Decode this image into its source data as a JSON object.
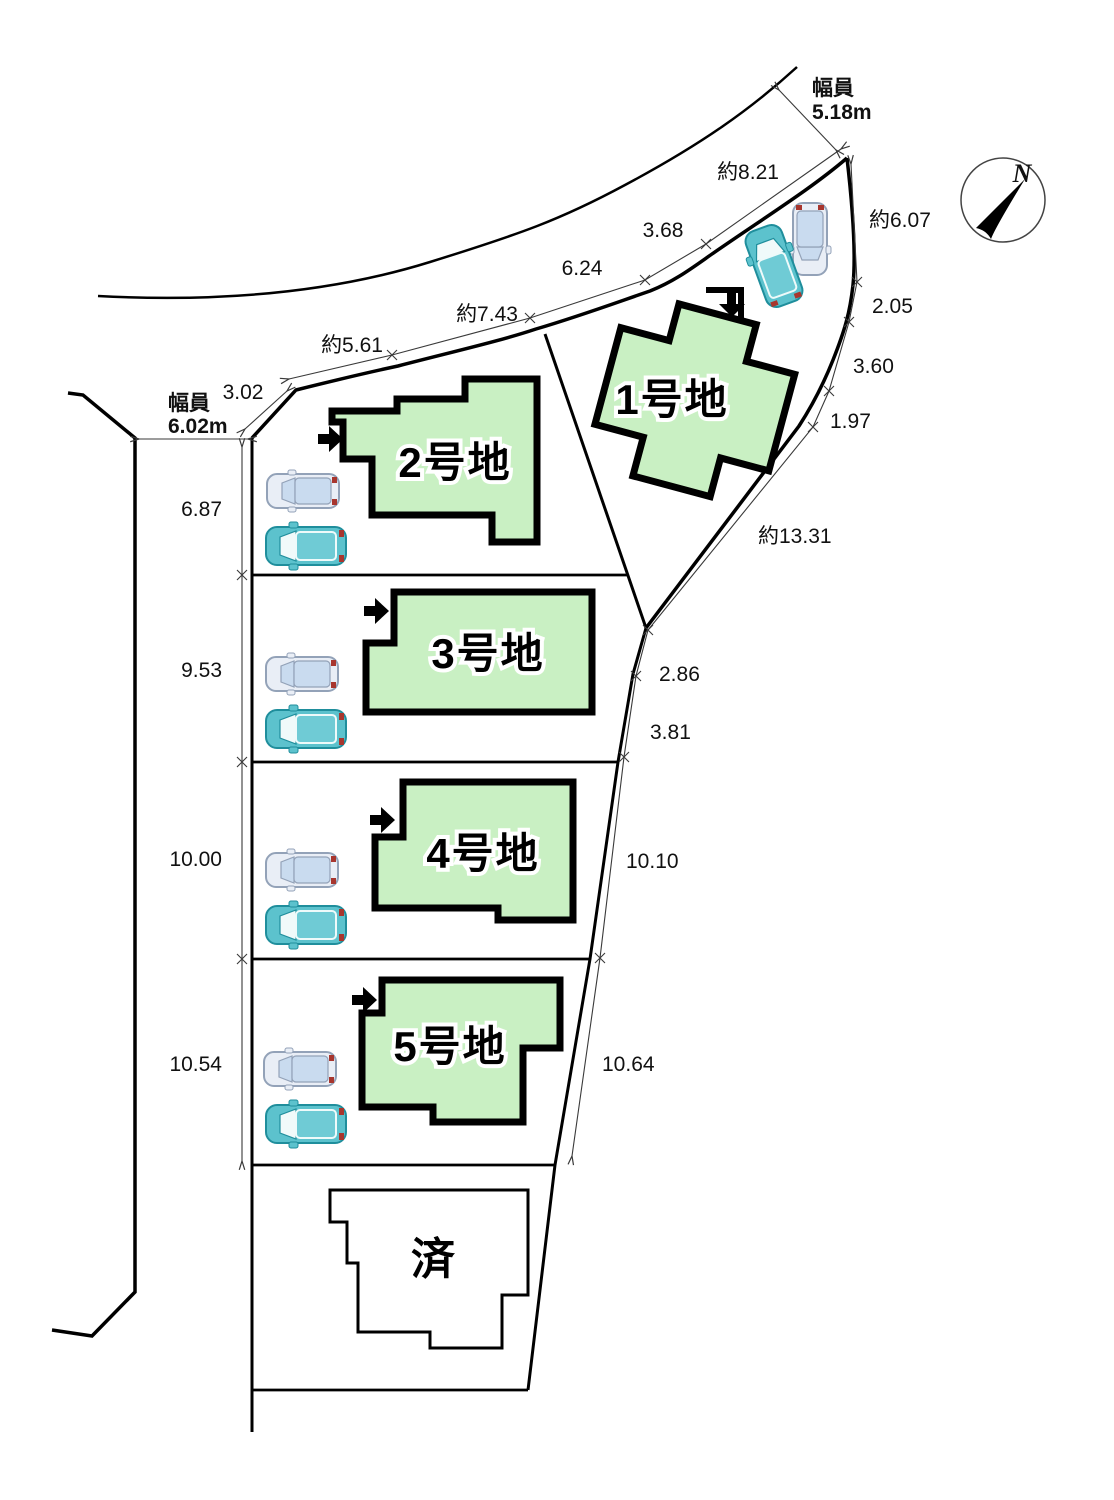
{
  "compass": {
    "label": "N"
  },
  "roads": {
    "top": {
      "label": "幅員",
      "value": "5.18m"
    },
    "left": {
      "label": "幅員",
      "value": "6.02m"
    }
  },
  "lots": [
    {
      "label": "1号地"
    },
    {
      "label": "2号地"
    },
    {
      "label": "3号地"
    },
    {
      "label": "4号地"
    },
    {
      "label": "5号地"
    },
    {
      "label": "済"
    }
  ],
  "dims": {
    "top": [
      "3.02",
      "約5.61",
      "約7.43",
      "6.24",
      "3.68",
      "約8.21"
    ],
    "right_upper": [
      "約6.07",
      "2.05",
      "3.60",
      "1.97",
      "約13.31"
    ],
    "right_lower": [
      "2.86",
      "3.81",
      "10.10",
      "10.64"
    ],
    "left": [
      "6.87",
      "9.53",
      "10.00",
      "10.54"
    ]
  }
}
